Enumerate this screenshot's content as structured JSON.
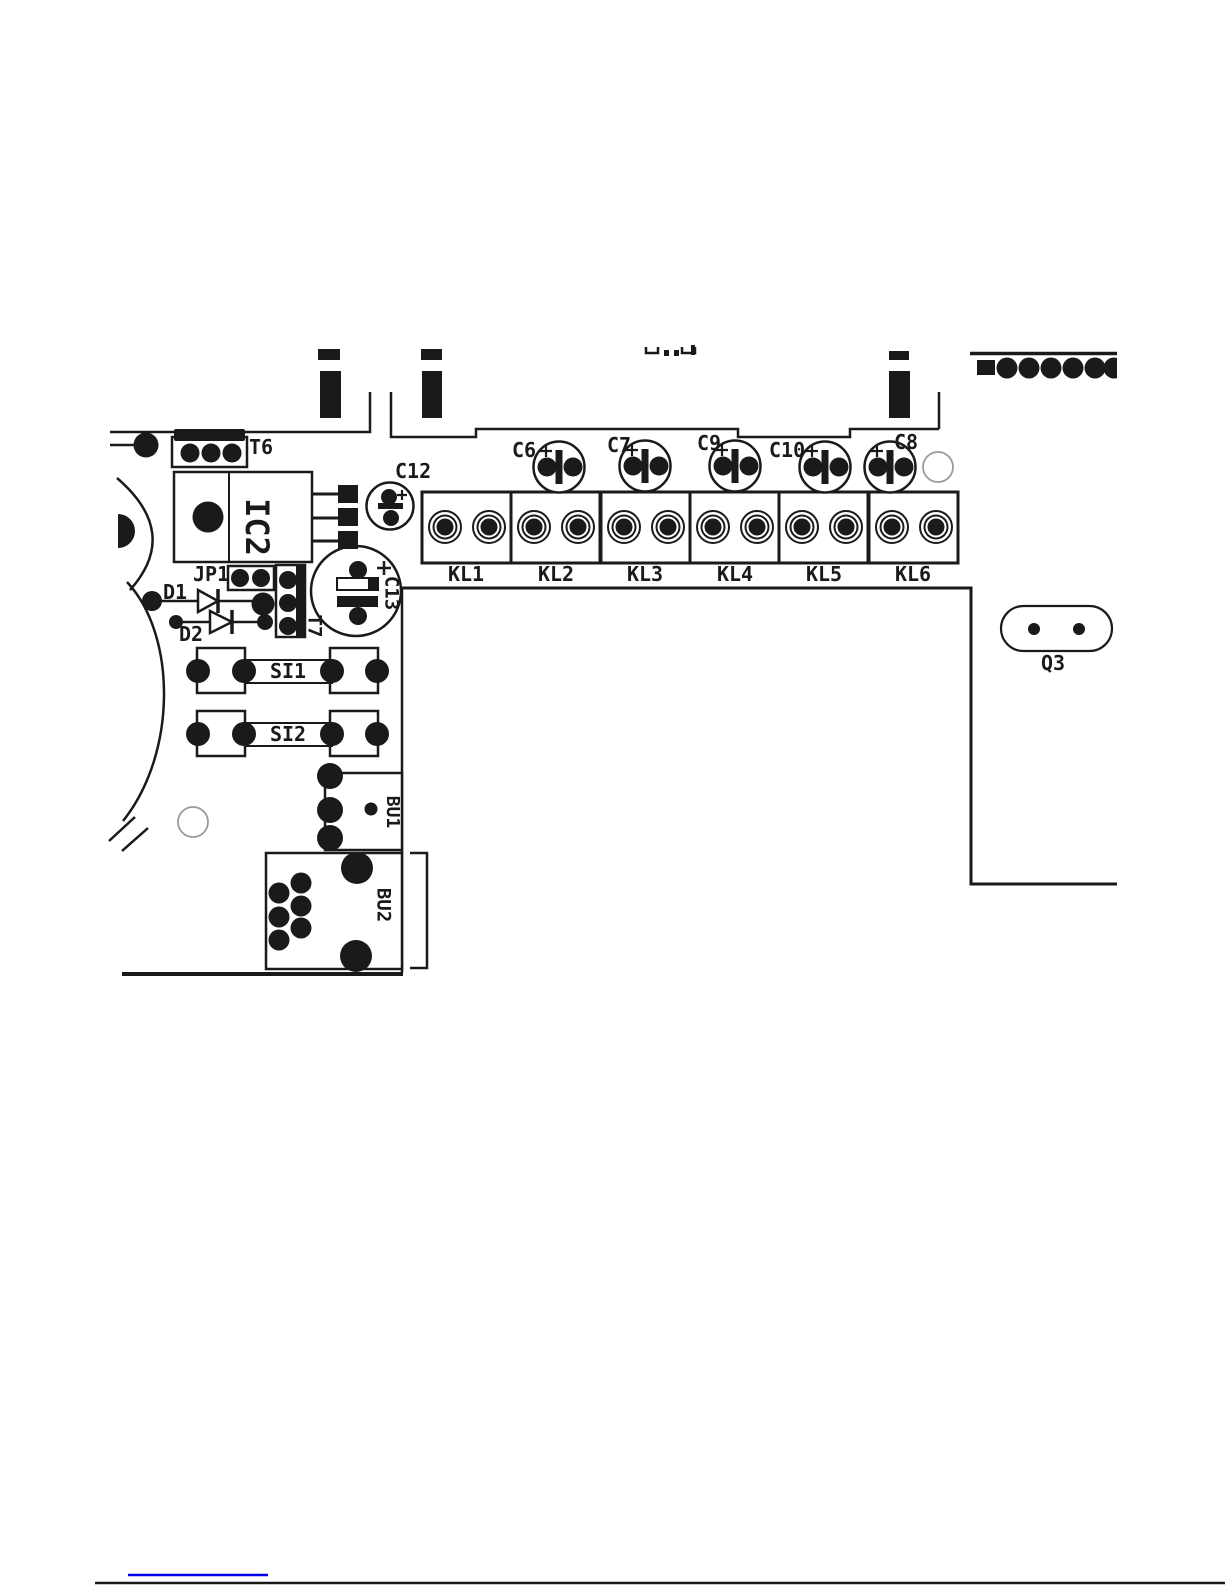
{
  "page": {
    "width": 1225,
    "height": 1585,
    "background": "#ffffff"
  },
  "pcb": {
    "t6": {
      "label": "T6"
    },
    "ic2": {
      "label": "IC2"
    },
    "c12": {
      "label": "C12"
    },
    "caps": [
      {
        "label": "C6"
      },
      {
        "label": "C7"
      },
      {
        "label": "C9"
      },
      {
        "label": "C10"
      },
      {
        "label": "C8"
      }
    ],
    "terminals": [
      {
        "label": "KL1"
      },
      {
        "label": "KL2"
      },
      {
        "label": "KL3"
      },
      {
        "label": "KL4"
      },
      {
        "label": "KL5"
      },
      {
        "label": "KL6"
      }
    ],
    "jp1": {
      "label": "JP1"
    },
    "d1": {
      "label": "D1"
    },
    "d2": {
      "label": "D2"
    },
    "t7": {
      "label": "T7"
    },
    "c13": {
      "label": "C13"
    },
    "si1": {
      "label": "SI1"
    },
    "si2": {
      "label": "SI2"
    },
    "bu1": {
      "label": "BU1"
    },
    "bu2": {
      "label": "BU2"
    },
    "q3": {
      "label": "Q3"
    },
    "polarity_mark": "+",
    "top_edge_text": "(letter bottoms clipped by page edge - unreadable)",
    "colors": {
      "ink": "#1a1a1a",
      "link": "#0000ee",
      "background": "#ffffff"
    }
  }
}
